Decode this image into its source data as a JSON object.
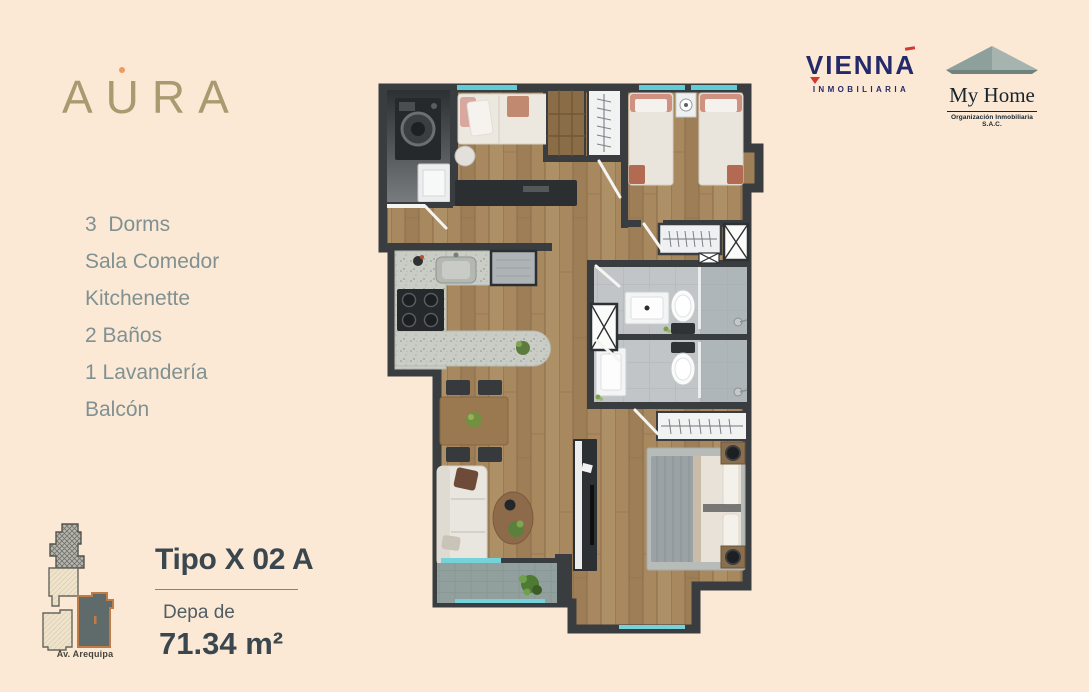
{
  "colors": {
    "background": "#FCE9D5",
    "brand_tan": "#A89B70",
    "accent_orange": "#EE9A60",
    "feature_text": "#7F9192",
    "heading_text": "#3A474E",
    "vienna_navy": "#24296A",
    "vienna_red": "#D63733",
    "wall_dark": "#393D3F",
    "glass_teal": "#74D2D8",
    "unit_highlight_outline": "#C07C47"
  },
  "branding": {
    "logo_text": "AURA"
  },
  "features": {
    "items": [
      "3  Dorms",
      "Sala Comedor",
      "Kitchenette",
      "2 Baños",
      "1 Lavandería",
      "Balcón"
    ]
  },
  "unit": {
    "type_label": "Tipo X 02 A",
    "area_prefix": "Depa de",
    "area_value": "71.34 m²"
  },
  "location": {
    "street_label": "Av. Arequipa"
  },
  "partners": {
    "vienna": {
      "name": "VIENNA",
      "tagline": "INMOBILIARIA"
    },
    "myhome": {
      "name": "My Home",
      "tagline": "Organización Inmobiliaria S.A.C."
    }
  }
}
